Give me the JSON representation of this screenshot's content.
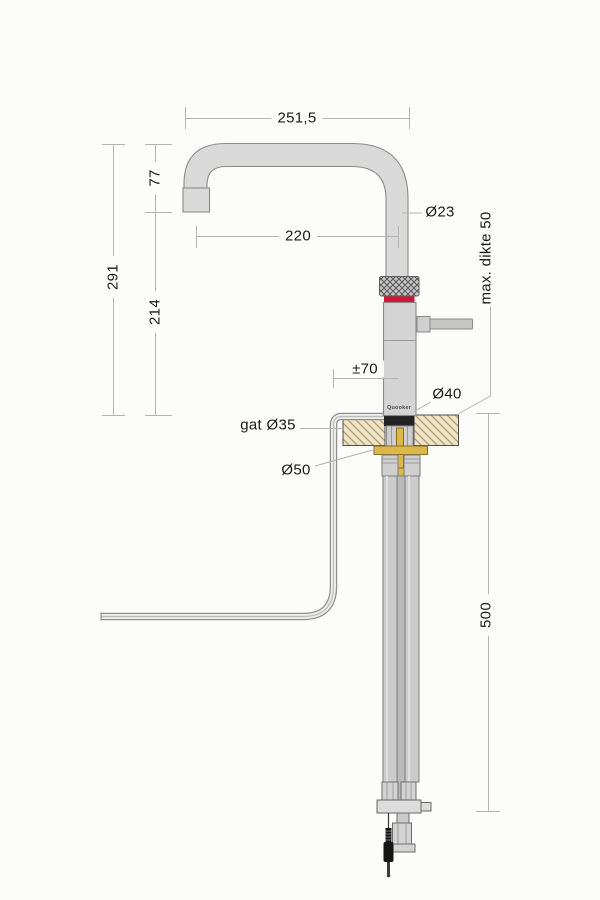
{
  "drawing": {
    "type": "technical-dimension-drawing",
    "subject": "Quooker kitchen tap, side view with mounting cross-section",
    "brand": "Quooker"
  },
  "labels": {
    "spout_width": "251,5",
    "spout_drop": "77",
    "total_height": "291",
    "base_height": "214",
    "reach": "220",
    "spout_diameter": "Ø23",
    "max_thickness": "max. dikte 50",
    "swivel_offset": "±70",
    "body_diameter": "Ø40",
    "hole_diameter": "gat Ø35",
    "plate_diameter": "Ø50",
    "below_counter_length": "500",
    "brand": "Quooker"
  },
  "colors": {
    "background": "#fcfcfa",
    "metal": "#d8d8d8",
    "metal_stroke": "#8a8a8a",
    "accent_red_band": "#d1143a",
    "counter_fill": "#efe3c2",
    "counter_hatch": "#a99c7c",
    "brass": "#dcb84c",
    "black_parts": "#1e1e1e",
    "dimension_lines": "#b3b3b3"
  }
}
